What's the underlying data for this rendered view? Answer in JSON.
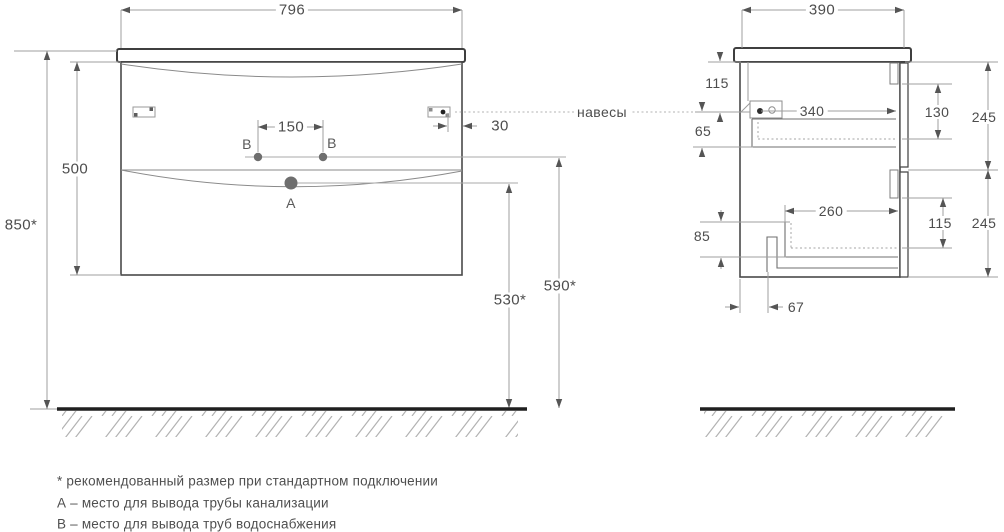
{
  "diagram": {
    "front": {
      "width": "796",
      "height": "500",
      "mount_height": "850*",
      "holes_spacing": "150",
      "hanger_offset": "30",
      "drain_height": "530*",
      "water_height": "590*",
      "point_a": "A",
      "point_b": "B"
    },
    "side": {
      "depth": "390",
      "hanger_top": "115",
      "basin_clearance": "65",
      "hanger_to_front": "340",
      "top_recess": "130",
      "top_section": "245",
      "drawer_clearance": "85",
      "drawer_inner": "260",
      "bottom_recess": "115",
      "bottom_section": "245",
      "back_offset": "67"
    },
    "hangers_label": "навесы"
  },
  "legend": {
    "note_recommended": "* рекомендованный размер при стандартном подключении",
    "note_a": "А – место для вывода трубы канализации",
    "note_b": "В – место для вывода труб водоснабжения"
  }
}
